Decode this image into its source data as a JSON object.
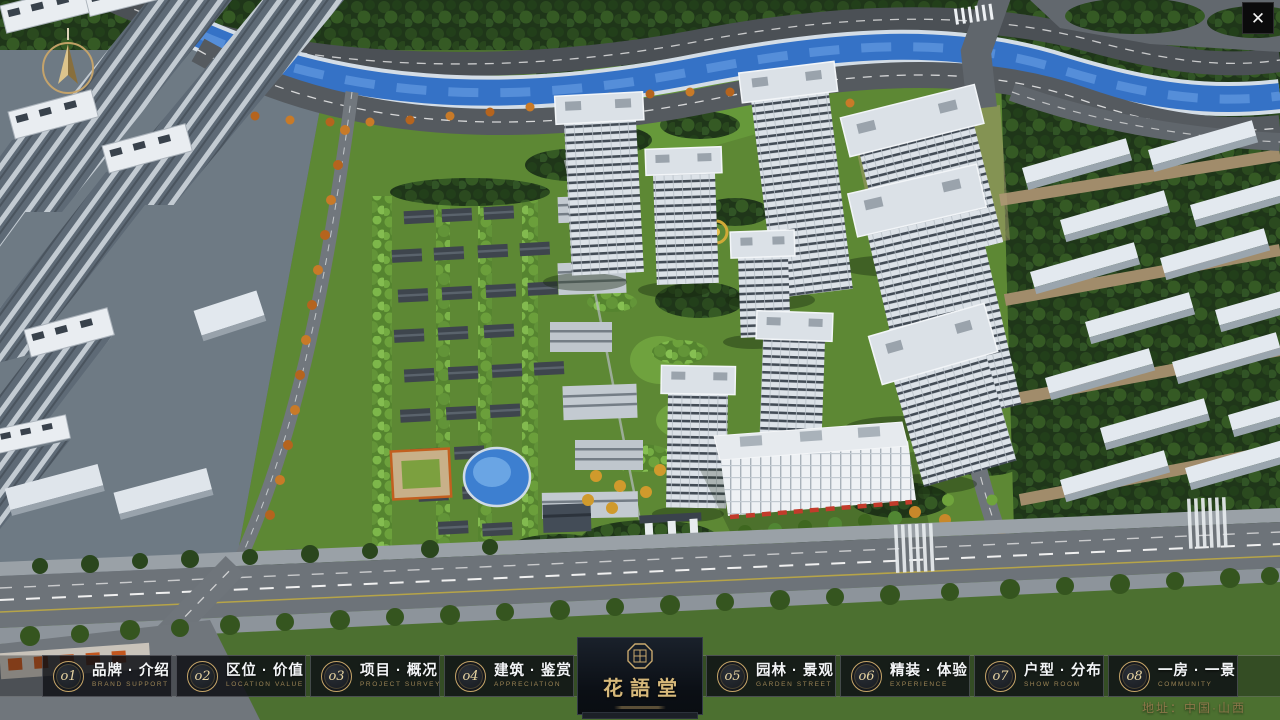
{
  "window": {
    "close_label": "✕"
  },
  "hud": {
    "address": "地址：中国·山西"
  },
  "logo": {
    "title": "花語堂"
  },
  "navbar": {
    "items": [
      {
        "num": "o1",
        "label": "品牌 · 介绍",
        "sublabel": "BRAND SUPPORT"
      },
      {
        "num": "o2",
        "label": "区位 · 价值",
        "sublabel": "LOCATION VALUE"
      },
      {
        "num": "o3",
        "label": "项目 · 概况",
        "sublabel": "PROJECT SURVEY"
      },
      {
        "num": "o4",
        "label": "建筑 · 鉴赏",
        "sublabel": "APPRECIATION"
      },
      {
        "num": "o5",
        "label": "园林 · 景观",
        "sublabel": "GARDEN STREET"
      },
      {
        "num": "o6",
        "label": "精装 · 体验",
        "sublabel": "EXPERIENCE"
      },
      {
        "num": "o7",
        "label": "户型 · 分布",
        "sublabel": "SHOW ROOM"
      },
      {
        "num": "o8",
        "label": "一房 · 一景",
        "sublabel": "COMMUNITY"
      }
    ]
  },
  "colors": {
    "gold": "#c6a568",
    "bar_bg": "#0e1014",
    "label": "#f3f5f7",
    "sublabel": "#9b8455"
  }
}
